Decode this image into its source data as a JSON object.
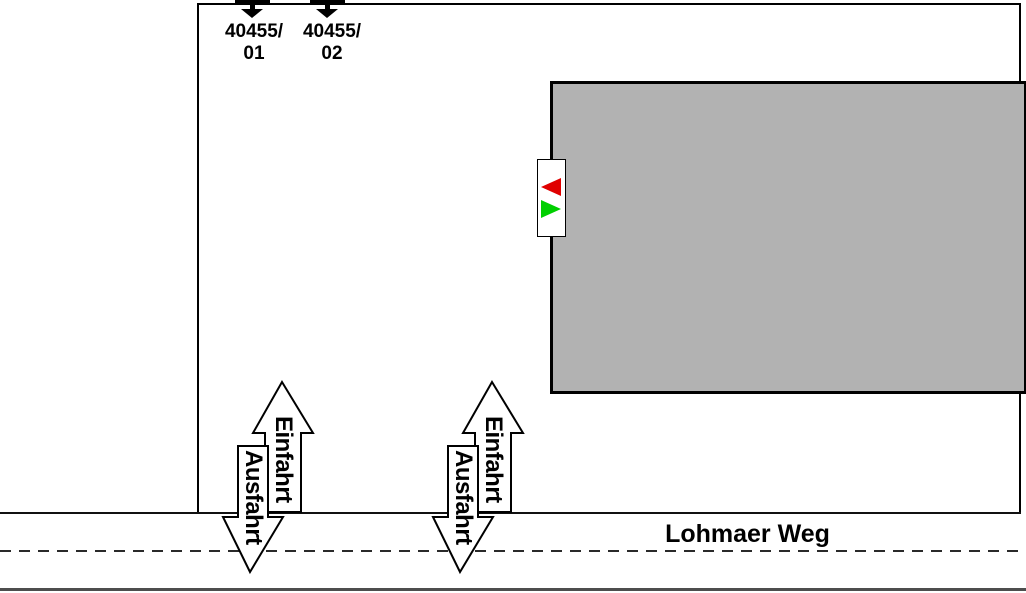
{
  "plan": {
    "street": {
      "name": "Lohmaer Weg"
    },
    "parcels": [
      {
        "line1": "40455/",
        "line2": "01"
      },
      {
        "line1": "40455/",
        "line2": "02"
      }
    ],
    "driveways": [
      {
        "entrance_label": "Einfahrt",
        "exit_label": "Ausfahrt"
      },
      {
        "entrance_label": "Einfahrt",
        "exit_label": "Ausfahrt"
      }
    ],
    "signal": {
      "red_arrow_color": "#e00000",
      "green_arrow_color": "#00cf00"
    },
    "colors": {
      "building_fill": "#b2b2b2",
      "line_black": "#000000",
      "road_edge_bottom": "#4d4d4d"
    }
  }
}
